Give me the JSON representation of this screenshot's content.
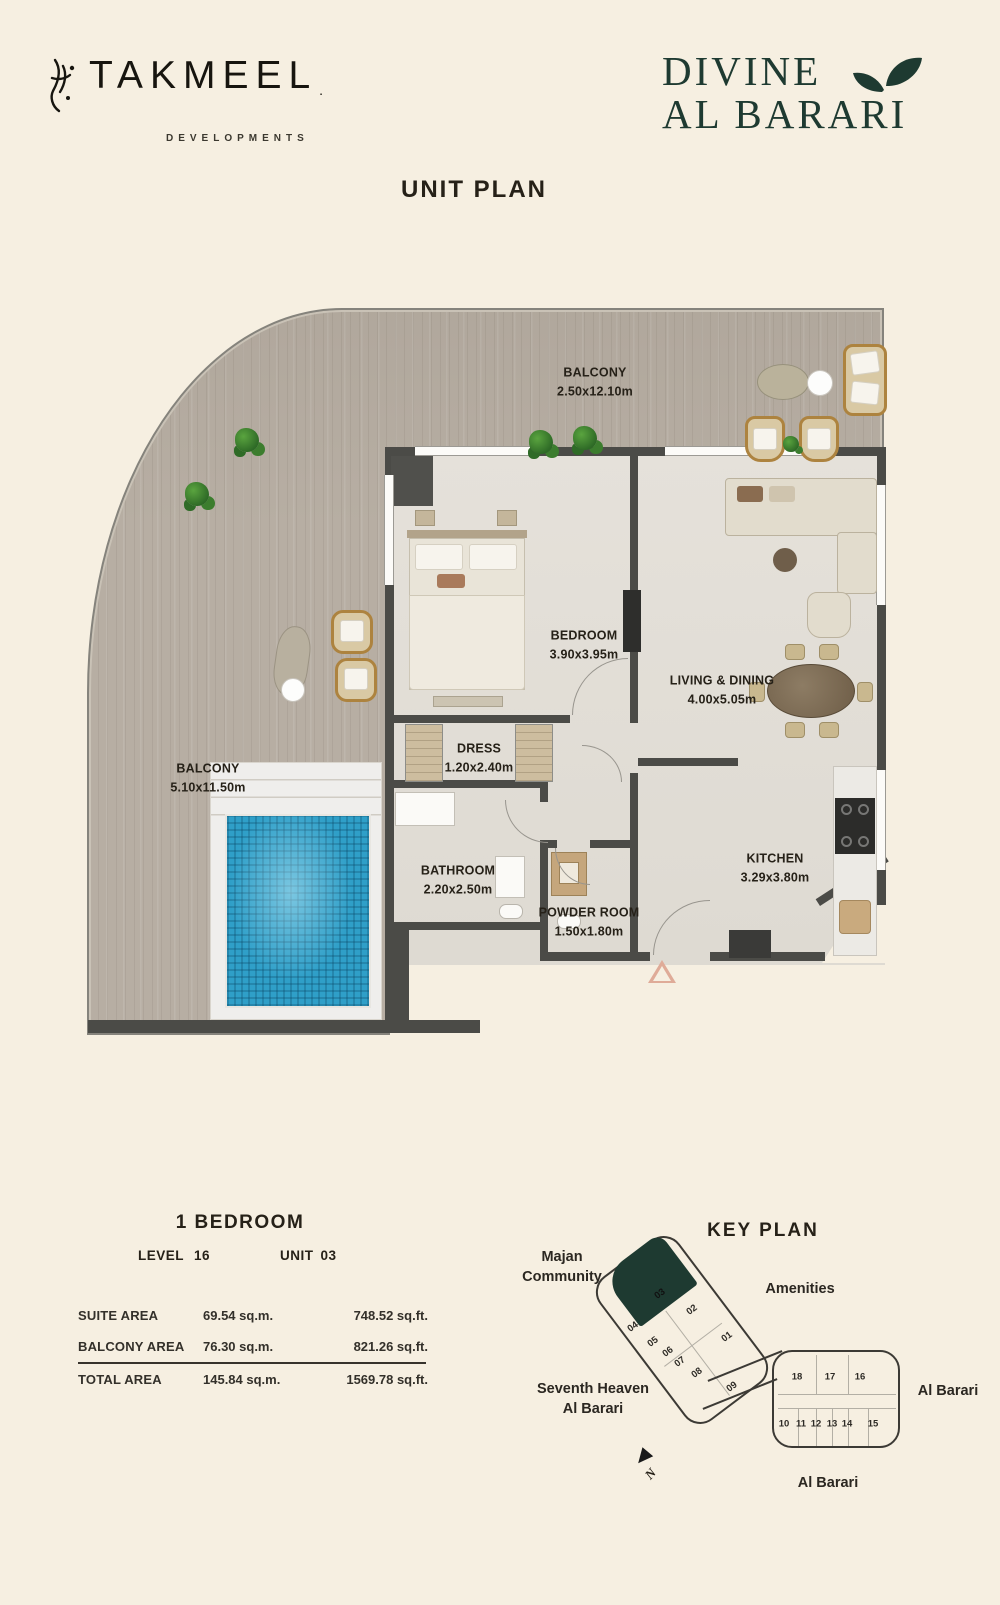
{
  "app": {
    "background": "#f6efe1",
    "accent_green": "#1e3a31",
    "wall_color": "#4b4b47",
    "pool_color": "#2f9fc8",
    "wood_color": "#b7aea3"
  },
  "header": {
    "brand_name": "TAKMEEL",
    "brand_suffix": ".",
    "brand_tagline": "DEVELOPMENTS",
    "project_name_line1": "DIVINE",
    "project_name_line2": "AL BARARI"
  },
  "page_title": "UNIT PLAN",
  "floor_plan": {
    "rooms": [
      {
        "name": "BALCONY",
        "dims": "2.50x12.10m"
      },
      {
        "name": "BEDROOM",
        "dims": "3.90x3.95m"
      },
      {
        "name": "LIVING & DINING",
        "dims": "4.00x5.05m"
      },
      {
        "name": "DRESS",
        "dims": "1.20x2.40m"
      },
      {
        "name": "BATHROOM",
        "dims": "2.20x2.50m"
      },
      {
        "name": "POWDER ROOM",
        "dims": "1.50x1.80m"
      },
      {
        "name": "KITCHEN",
        "dims": "3.29x3.80m"
      },
      {
        "name": "BALCONY",
        "dims": "5.10x11.50m"
      }
    ]
  },
  "unit_info": {
    "type": "1 BEDROOM",
    "level_label": "LEVEL",
    "level_value": "16",
    "unit_label": "UNIT",
    "unit_value": "03",
    "rows": [
      {
        "label": "SUITE AREA",
        "sqm": "69.54 sq.m.",
        "sqft": "748.52 sq.ft."
      },
      {
        "label": "BALCONY AREA",
        "sqm": "76.30 sq.m.",
        "sqft": "821.26 sq.ft."
      },
      {
        "label": "TOTAL AREA",
        "sqm": "145.84 sq.m.",
        "sqft": "1569.78 sq.ft."
      }
    ]
  },
  "key_plan": {
    "title": "KEY PLAN",
    "highlighted_unit": "03",
    "labels": {
      "majan_line1": "Majan",
      "majan_line2": "Community",
      "amenities": "Amenities",
      "seventh_line1": "Seventh Heaven",
      "seventh_line2": "Al Barari",
      "al_barari_right": "Al Barari",
      "al_barari_bottom": "Al Barari",
      "north": "N"
    },
    "left_units": [
      "03",
      "02",
      "04",
      "01",
      "05",
      "06",
      "07",
      "08",
      "09"
    ],
    "right_units_top": [
      "18",
      "17",
      "16"
    ],
    "right_units_bottom": [
      "10",
      "11",
      "12",
      "13",
      "14",
      "15"
    ]
  }
}
